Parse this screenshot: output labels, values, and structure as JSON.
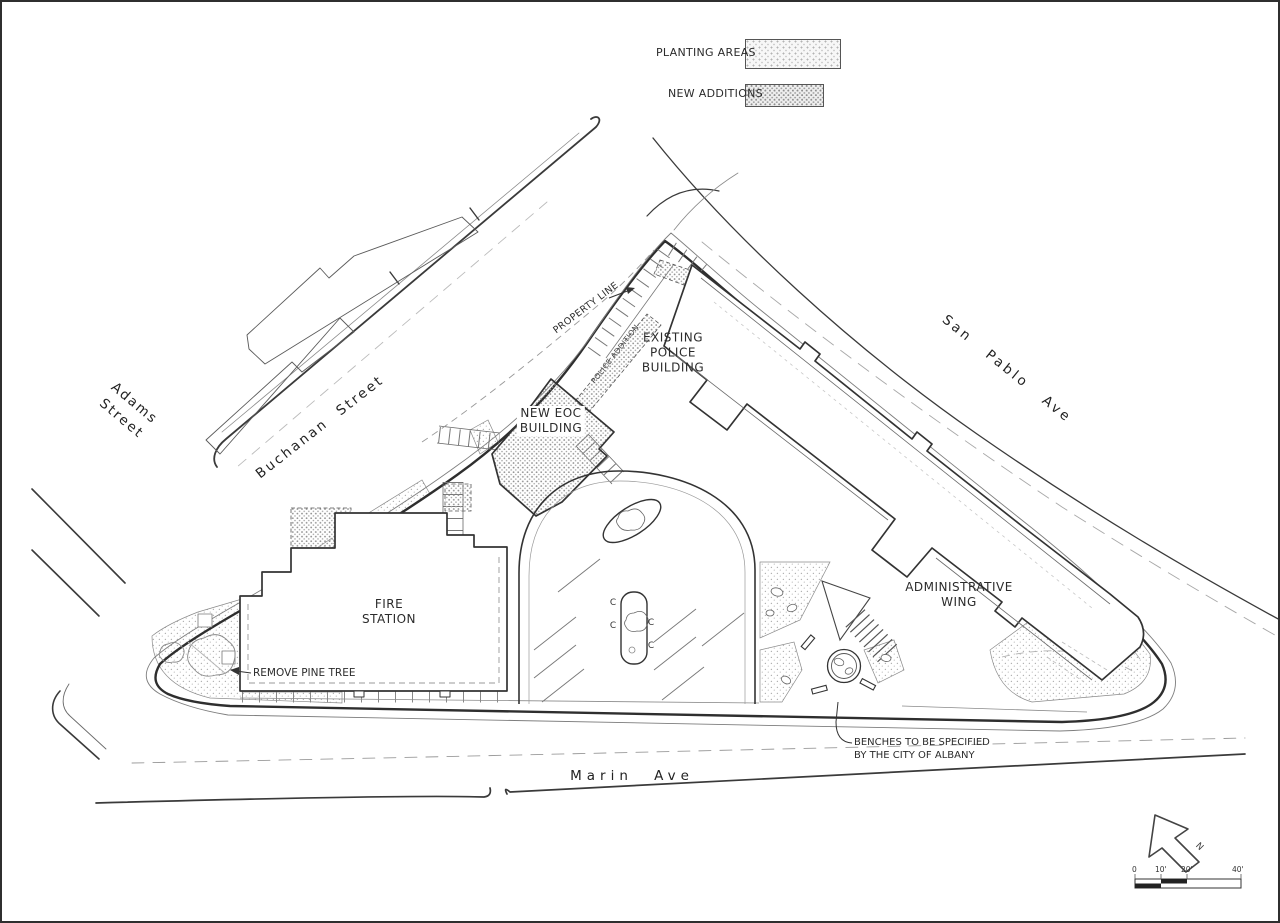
{
  "drawing": {
    "legend": {
      "planting_label": "PLANTING AREAS",
      "additions_label": "NEW ADDITIONS"
    },
    "streets": {
      "adams_l1": "Adams",
      "adams_l2": "Street",
      "buchanan": "Buchanan Street",
      "san_pablo": "San Pablo Ave",
      "marin": "Marin Ave"
    },
    "buildings": {
      "police_l1": "EXISTING",
      "police_l2": "POLICE",
      "police_l3": "BUILDING",
      "eoc_l1": "NEW EOC",
      "eoc_l2": "BUILDING",
      "fire_l1": "FIRE",
      "fire_l2": "STATION",
      "admin_l1": "ADMINISTRATIVE",
      "admin_l2": "WING"
    },
    "annotations": {
      "property_line": "PROPERTY LINE",
      "police_addition": "POLICE ADDITION",
      "remove_pine_tree": "REMOVE PINE TREE",
      "benches_l1": "BENCHES TO BE SPECIFIED",
      "benches_l2": "BY THE CITY OF ALBANY",
      "stall_mark": "C"
    },
    "north_arrow_label": "N",
    "scale": {
      "t0": "0",
      "t1": "10'",
      "t2": "20'",
      "t3": "40'"
    }
  },
  "colors": {
    "paper": "#ffffff",
    "line_dark": "#2e2e2e",
    "line_medium": "#4a4a4a",
    "line_light": "#8f8f8f",
    "stipple_dot": "#9a9a9a"
  }
}
